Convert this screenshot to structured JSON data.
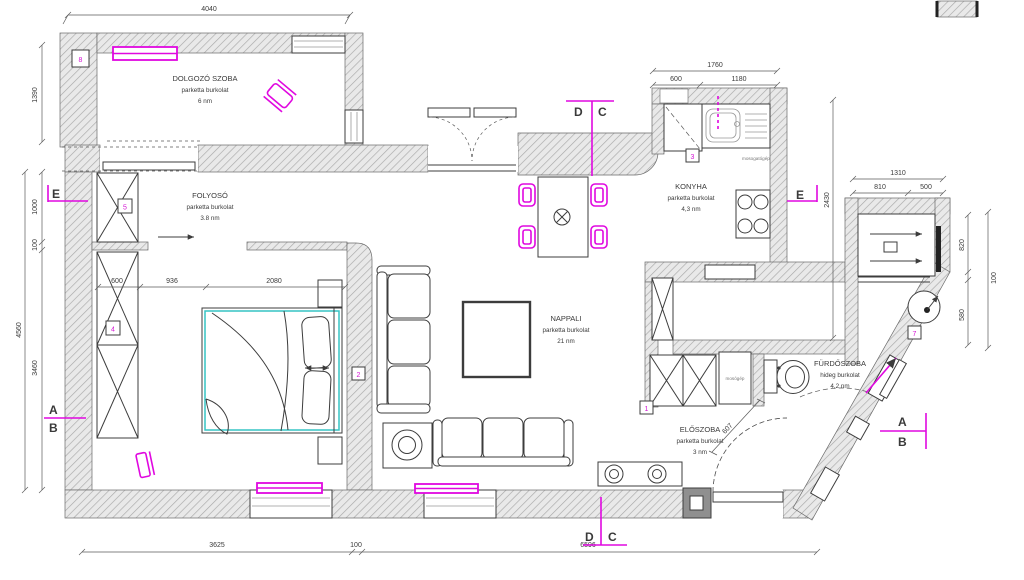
{
  "colors": {
    "magenta": "#e008e0",
    "cyan": "#35c4c4",
    "wall_hatch": "#a8a8a8",
    "line": "#3c3c3c"
  },
  "rooms": {
    "dolgozo": {
      "name": "DOLGOZÓ SZOBA",
      "floor": "parketta burkolat",
      "area": "6 nm"
    },
    "folyoso": {
      "name": "FOLYOSÓ",
      "floor": "parketta burkolat",
      "area": "3.8 nm"
    },
    "konyha": {
      "name": "KONYHA",
      "floor": "parketta burkolat",
      "area": "4,3 nm"
    },
    "nappali": {
      "name": "NAPPALI",
      "floor": "parketta burkolat",
      "area": "21 nm"
    },
    "furdoszoba": {
      "name": "FÜRDŐSZOBA",
      "floor": "hideg burkolat",
      "area": "4,2 nm"
    },
    "eloszoba": {
      "name": "ELŐSZOBA",
      "floor": "parketta burkolat",
      "area": "3 nm"
    }
  },
  "appliances": {
    "dishwasher": "mosogatógép",
    "washer": "mosógép"
  },
  "dims": {
    "top": "4040",
    "left_1390": "1390",
    "left_1000": "1000",
    "left_100": "100",
    "left_4560": "4560",
    "left_3460": "3460",
    "bed_600": "600",
    "bed_936": "936",
    "bed_2080": "2080",
    "kit_1760": "1760",
    "kit_600": "600",
    "kit_1180": "1180",
    "kit_2430": "2430",
    "right_1310": "1310",
    "right_810": "810",
    "right_500": "500",
    "right_820": "820",
    "right_100": "100",
    "right_580": "580",
    "hall_607": "607",
    "bottom_3625": "3625",
    "bottom_100": "100",
    "bottom_6596": "6596"
  },
  "sections": {
    "d": "D",
    "c": "C",
    "e": "E",
    "a": "A",
    "b": "B"
  },
  "markers": {
    "m1": "1",
    "m2": "2",
    "m3": "3",
    "m4": "4",
    "m5": "5",
    "m7": "7",
    "m8": "8"
  }
}
